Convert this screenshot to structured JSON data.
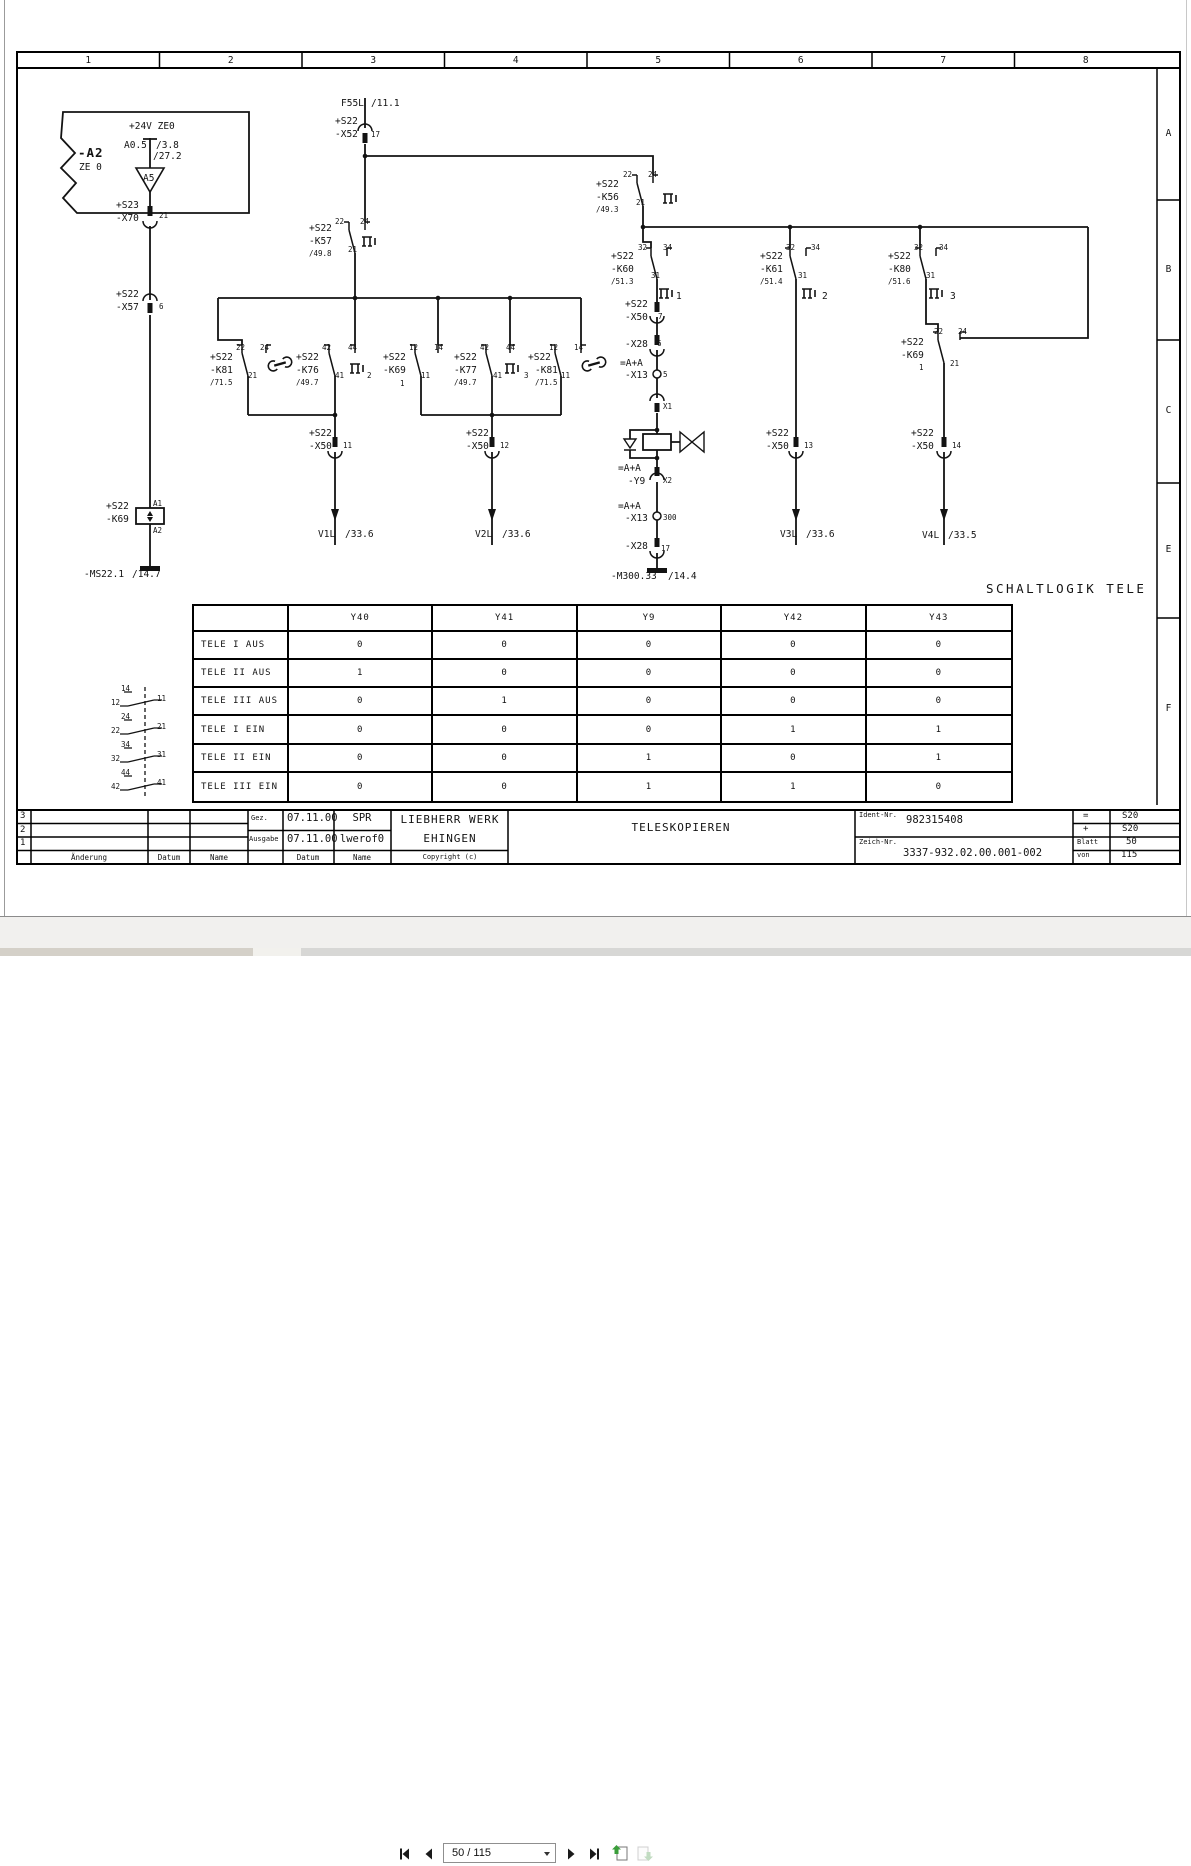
{
  "viewer": {
    "toolbar": {
      "page_field": "50 / 115"
    }
  },
  "drawing": {
    "column_headers": [
      "1",
      "2",
      "3",
      "4",
      "5",
      "6",
      "7",
      "8"
    ],
    "row_letters": [
      "A",
      "B",
      "C",
      "E",
      "F"
    ],
    "schaltlogik_title": "SCHALTLOGIK TELE",
    "logic_table": {
      "columns": [
        "",
        "Y40",
        "Y41",
        "Y9",
        "Y42",
        "Y43"
      ],
      "rows": [
        {
          "label": "TELE I AUS",
          "values": [
            "0",
            "0",
            "0",
            "0",
            "0"
          ]
        },
        {
          "label": "TELE II AUS",
          "values": [
            "1",
            "0",
            "0",
            "0",
            "0"
          ]
        },
        {
          "label": "TELE III AUS",
          "values": [
            "0",
            "1",
            "0",
            "0",
            "0"
          ]
        },
        {
          "label": "TELE I EIN",
          "values": [
            "0",
            "0",
            "0",
            "1",
            "1"
          ]
        },
        {
          "label": "TELE II EIN",
          "values": [
            "0",
            "0",
            "1",
            "0",
            "1"
          ]
        },
        {
          "label": "TELE III EIN",
          "values": [
            "0",
            "0",
            "1",
            "1",
            "0"
          ]
        }
      ]
    },
    "title_block": {
      "rev_rows": [
        "3",
        "2",
        "1"
      ],
      "aenderung_label": "Änderung",
      "datum_label": "Datum",
      "name_label": "Name",
      "gez_label": "Gez.",
      "gez_datum": "07.11.00",
      "gez_name": "SPR",
      "ausgabe_label": "Ausgabe",
      "ausgabe_datum": "07.11.00",
      "ausgabe_name": "lwerof0",
      "datum_col_label": "Datum",
      "name_col_label": "Name",
      "company_line1": "LIEBHERR WERK",
      "company_line2": "EHINGEN",
      "copyright": "Copyright (c)",
      "title": "TELESKOPIEREN",
      "ident_label": "Ident-Nr.",
      "ident_value": "982315408",
      "zeich_label": "Zeich-Nr.",
      "zeich_value": "3337-932.02.00.001-002",
      "eq_label": "=",
      "eq_value": "S20",
      "plus_label": "+",
      "plus_value": "S20",
      "blatt_label": "Blatt",
      "blatt_value": "50",
      "von_label": "von",
      "von_value": "115"
    },
    "labels": [
      {
        "t": "-A2",
        "x": 78,
        "y": 147,
        "s": 12
      },
      {
        "t": "ZE 0",
        "x": 79,
        "y": 163
      },
      {
        "t": "+24V ZE0",
        "x": 129,
        "y": 122
      },
      {
        "t": "A0.5",
        "x": 124,
        "y": 141
      },
      {
        "t": "/3.8",
        "x": 156,
        "y": 141
      },
      {
        "t": "/27.2",
        "x": 153,
        "y": 152
      },
      {
        "t": "A5",
        "x": 143,
        "y": 174
      },
      {
        "t": "+S23",
        "x": 116,
        "y": 201
      },
      {
        "t": "-X70",
        "x": 116,
        "y": 214
      },
      {
        "t": "21",
        "x": 159,
        "y": 212,
        "s": 8
      },
      {
        "t": "+S22",
        "x": 116,
        "y": 290
      },
      {
        "t": "-X57",
        "x": 116,
        "y": 303
      },
      {
        "t": "6",
        "x": 159,
        "y": 303,
        "s": 8
      },
      {
        "t": "+S22",
        "x": 106,
        "y": 502
      },
      {
        "t": "-K69",
        "x": 106,
        "y": 515
      },
      {
        "t": "A1",
        "x": 153,
        "y": 500,
        "s": 8
      },
      {
        "t": "A2",
        "x": 153,
        "y": 527,
        "s": 8
      },
      {
        "t": "-MS22.1",
        "x": 84,
        "y": 570
      },
      {
        "t": "/14.7",
        "x": 132,
        "y": 570
      },
      {
        "t": "F55L",
        "x": 341,
        "y": 99
      },
      {
        "t": "/11.1",
        "x": 371,
        "y": 99
      },
      {
        "t": "+S22",
        "x": 335,
        "y": 117
      },
      {
        "t": "-X52",
        "x": 335,
        "y": 130
      },
      {
        "t": "17",
        "x": 371,
        "y": 131,
        "s": 8
      },
      {
        "t": "+S22",
        "x": 309,
        "y": 224
      },
      {
        "t": "-K57",
        "x": 309,
        "y": 237
      },
      {
        "t": "/49.8",
        "x": 309,
        "y": 250,
        "s": 8
      },
      {
        "t": "22",
        "x": 335,
        "y": 218,
        "s": 8
      },
      {
        "t": "24",
        "x": 360,
        "y": 218,
        "s": 8
      },
      {
        "t": "21",
        "x": 348,
        "y": 246,
        "s": 8
      },
      {
        "t": "+S22",
        "x": 596,
        "y": 180
      },
      {
        "t": "-K56",
        "x": 596,
        "y": 193
      },
      {
        "t": "/49.3",
        "x": 596,
        "y": 206,
        "s": 8
      },
      {
        "t": "22",
        "x": 623,
        "y": 171,
        "s": 8
      },
      {
        "t": "24",
        "x": 648,
        "y": 171,
        "s": 8
      },
      {
        "t": "21",
        "x": 636,
        "y": 199,
        "s": 8
      },
      {
        "t": "+S22",
        "x": 611,
        "y": 252
      },
      {
        "t": "-K60",
        "x": 611,
        "y": 265
      },
      {
        "t": "/51.3",
        "x": 611,
        "y": 278,
        "s": 8
      },
      {
        "t": "32",
        "x": 638,
        "y": 244,
        "s": 8
      },
      {
        "t": "34",
        "x": 663,
        "y": 244,
        "s": 8
      },
      {
        "t": "31",
        "x": 651,
        "y": 272,
        "s": 8
      },
      {
        "t": "1",
        "x": 676,
        "y": 292
      },
      {
        "t": "+S22",
        "x": 625,
        "y": 300
      },
      {
        "t": "-X50",
        "x": 625,
        "y": 313
      },
      {
        "t": "7",
        "x": 658,
        "y": 313,
        "s": 8
      },
      {
        "t": "-X28",
        "x": 625,
        "y": 340
      },
      {
        "t": "6",
        "x": 657,
        "y": 340,
        "s": 8
      },
      {
        "t": "=A+A",
        "x": 620,
        "y": 359
      },
      {
        "t": "-X13",
        "x": 625,
        "y": 371
      },
      {
        "t": "5",
        "x": 663,
        "y": 371,
        "s": 8
      },
      {
        "t": "X1",
        "x": 663,
        "y": 403,
        "s": 8
      },
      {
        "t": "=A+A",
        "x": 618,
        "y": 464
      },
      {
        "t": "-Y9",
        "x": 628,
        "y": 477
      },
      {
        "t": "X2",
        "x": 663,
        "y": 477,
        "s": 8
      },
      {
        "t": "=A+A",
        "x": 618,
        "y": 502
      },
      {
        "t": "-X13",
        "x": 625,
        "y": 514
      },
      {
        "t": "300",
        "x": 663,
        "y": 514,
        "s": 8
      },
      {
        "t": "-X28",
        "x": 625,
        "y": 542
      },
      {
        "t": "17",
        "x": 661,
        "y": 545,
        "s": 8
      },
      {
        "t": "-M300.33",
        "x": 611,
        "y": 572
      },
      {
        "t": "/14.4",
        "x": 668,
        "y": 572
      },
      {
        "t": "+S22",
        "x": 760,
        "y": 252
      },
      {
        "t": "-K61",
        "x": 760,
        "y": 265
      },
      {
        "t": "/51.4",
        "x": 760,
        "y": 278,
        "s": 8
      },
      {
        "t": "32",
        "x": 786,
        "y": 244,
        "s": 8
      },
      {
        "t": "34",
        "x": 811,
        "y": 244,
        "s": 8
      },
      {
        "t": "31",
        "x": 798,
        "y": 272,
        "s": 8
      },
      {
        "t": "2",
        "x": 822,
        "y": 292
      },
      {
        "t": "+S22",
        "x": 766,
        "y": 429
      },
      {
        "t": "-X50",
        "x": 766,
        "y": 442
      },
      {
        "t": "13",
        "x": 804,
        "y": 442,
        "s": 8
      },
      {
        "t": "V3L",
        "x": 780,
        "y": 530
      },
      {
        "t": "/33.6",
        "x": 806,
        "y": 530
      },
      {
        "t": "+S22",
        "x": 888,
        "y": 252
      },
      {
        "t": "-K80",
        "x": 888,
        "y": 265
      },
      {
        "t": "/51.6",
        "x": 888,
        "y": 278,
        "s": 8
      },
      {
        "t": "32",
        "x": 914,
        "y": 244,
        "s": 8
      },
      {
        "t": "34",
        "x": 939,
        "y": 244,
        "s": 8
      },
      {
        "t": "31",
        "x": 926,
        "y": 272,
        "s": 8
      },
      {
        "t": "3",
        "x": 950,
        "y": 292
      },
      {
        "t": "+S22",
        "x": 901,
        "y": 338
      },
      {
        "t": "-K69",
        "x": 901,
        "y": 351
      },
      {
        "t": "1",
        "x": 919,
        "y": 364,
        "s": 8
      },
      {
        "t": "22",
        "x": 934,
        "y": 328,
        "s": 8
      },
      {
        "t": "24",
        "x": 958,
        "y": 328,
        "s": 8
      },
      {
        "t": "21",
        "x": 950,
        "y": 360,
        "s": 8
      },
      {
        "t": "+S22",
        "x": 911,
        "y": 429
      },
      {
        "t": "-X50",
        "x": 911,
        "y": 442
      },
      {
        "t": "14",
        "x": 952,
        "y": 442,
        "s": 8
      },
      {
        "t": "V4L",
        "x": 922,
        "y": 531
      },
      {
        "t": "/33.5",
        "x": 948,
        "y": 531
      },
      {
        "t": "+S22",
        "x": 210,
        "y": 353
      },
      {
        "t": "-K81",
        "x": 210,
        "y": 366
      },
      {
        "t": "/71.5",
        "x": 210,
        "y": 379,
        "s": 8
      },
      {
        "t": "22",
        "x": 236,
        "y": 344,
        "s": 8
      },
      {
        "t": "24",
        "x": 260,
        "y": 344,
        "s": 8
      },
      {
        "t": "21",
        "x": 248,
        "y": 372,
        "s": 8
      },
      {
        "t": "+S22",
        "x": 296,
        "y": 353
      },
      {
        "t": "-K76",
        "x": 296,
        "y": 366
      },
      {
        "t": "/49.7",
        "x": 296,
        "y": 379,
        "s": 8
      },
      {
        "t": "42",
        "x": 322,
        "y": 344,
        "s": 8
      },
      {
        "t": "44",
        "x": 348,
        "y": 344,
        "s": 8
      },
      {
        "t": "41",
        "x": 335,
        "y": 372,
        "s": 8
      },
      {
        "t": "2",
        "x": 367,
        "y": 372,
        "s": 8
      },
      {
        "t": "+S22",
        "x": 383,
        "y": 353
      },
      {
        "t": "-K69",
        "x": 383,
        "y": 366
      },
      {
        "t": "1",
        "x": 400,
        "y": 380,
        "s": 8
      },
      {
        "t": "12",
        "x": 409,
        "y": 344,
        "s": 8
      },
      {
        "t": "14",
        "x": 434,
        "y": 344,
        "s": 8
      },
      {
        "t": "11",
        "x": 421,
        "y": 372,
        "s": 8
      },
      {
        "t": "+S22",
        "x": 454,
        "y": 353
      },
      {
        "t": "-K77",
        "x": 454,
        "y": 366
      },
      {
        "t": "/49.7",
        "x": 454,
        "y": 379,
        "s": 8
      },
      {
        "t": "42",
        "x": 480,
        "y": 344,
        "s": 8
      },
      {
        "t": "44",
        "x": 506,
        "y": 344,
        "s": 8
      },
      {
        "t": "41",
        "x": 493,
        "y": 372,
        "s": 8
      },
      {
        "t": "3",
        "x": 524,
        "y": 372,
        "s": 8
      },
      {
        "t": "+S22",
        "x": 528,
        "y": 353
      },
      {
        "t": "-K81",
        "x": 535,
        "y": 366
      },
      {
        "t": "/71.5",
        "x": 535,
        "y": 379,
        "s": 8
      },
      {
        "t": "12",
        "x": 549,
        "y": 344,
        "s": 8
      },
      {
        "t": "14",
        "x": 574,
        "y": 344,
        "s": 8
      },
      {
        "t": "11",
        "x": 561,
        "y": 372,
        "s": 8
      },
      {
        "t": "+S22",
        "x": 309,
        "y": 429
      },
      {
        "t": "-X50",
        "x": 309,
        "y": 442
      },
      {
        "t": "11",
        "x": 343,
        "y": 442,
        "s": 8
      },
      {
        "t": "V1L",
        "x": 318,
        "y": 530
      },
      {
        "t": "/33.6",
        "x": 345,
        "y": 530
      },
      {
        "t": "+S22",
        "x": 466,
        "y": 429
      },
      {
        "t": "-X50",
        "x": 466,
        "y": 442
      },
      {
        "t": "12",
        "x": 500,
        "y": 442,
        "s": 8
      },
      {
        "t": "V2L",
        "x": 475,
        "y": 530
      },
      {
        "t": "/33.6",
        "x": 502,
        "y": 530
      },
      {
        "t": "14",
        "x": 121,
        "y": 685,
        "s": 8
      },
      {
        "t": "12",
        "x": 111,
        "y": 699,
        "s": 8
      },
      {
        "t": "11",
        "x": 157,
        "y": 695,
        "s": 8
      },
      {
        "t": ".3",
        "x": 194,
        "y": 701,
        "s": 8
      },
      {
        "t": "24",
        "x": 121,
        "y": 713,
        "s": 8
      },
      {
        "t": "22",
        "x": 111,
        "y": 727,
        "s": 8
      },
      {
        "t": "21",
        "x": 157,
        "y": 723,
        "s": 8
      },
      {
        "t": ".7",
        "x": 194,
        "y": 729,
        "s": 8
      },
      {
        "t": "34",
        "x": 121,
        "y": 741,
        "s": 8
      },
      {
        "t": "32",
        "x": 111,
        "y": 755,
        "s": 8
      },
      {
        "t": "31",
        "x": 157,
        "y": 751,
        "s": 8
      },
      {
        "t": "44",
        "x": 121,
        "y": 769,
        "s": 8
      },
      {
        "t": "42",
        "x": 111,
        "y": 783,
        "s": 8
      },
      {
        "t": "41",
        "x": 157,
        "y": 779,
        "s": 8
      }
    ]
  }
}
